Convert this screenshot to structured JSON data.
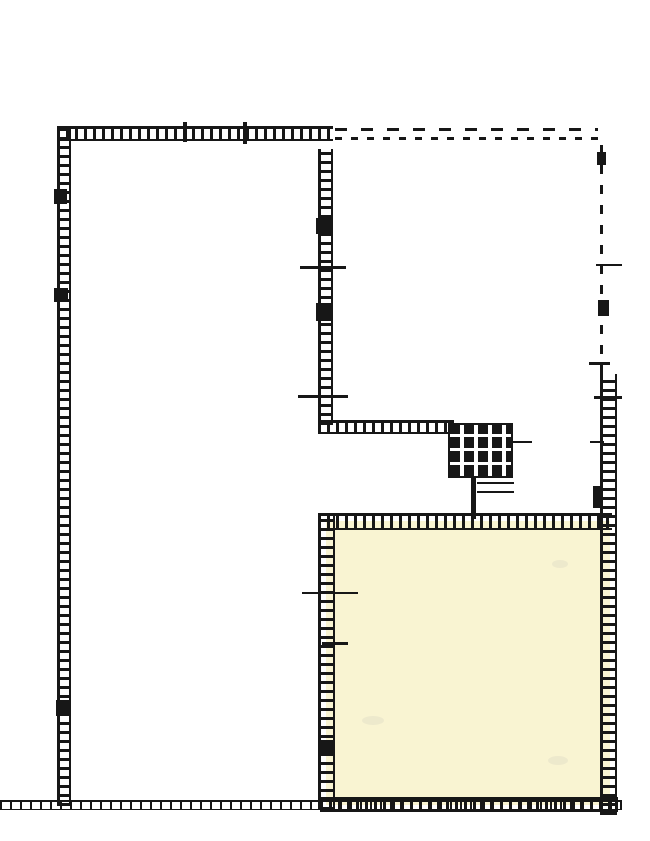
{
  "document": {
    "description": "Scanned monochrome architectural floor plan; cross-hatched walls, dashed upper-right perimeter, central cross-hatched stair block, cream-highlighted room at lower right"
  },
  "plan": {
    "canvas": {
      "width": 650,
      "height": 841,
      "background": "#ffffff"
    },
    "colors": {
      "ink": "#171717",
      "room_fill": "#f9f4d2",
      "smudge": "#ebe6cb"
    },
    "elements": [
      {
        "name": "highlighted-room-fill",
        "type": "room",
        "x": 326,
        "y": 521,
        "w": 284,
        "h": 284
      },
      {
        "name": "room-smudge-1",
        "type": "smudge",
        "x": 552,
        "y": 560,
        "w": 16,
        "h": 8
      },
      {
        "name": "room-smudge-2",
        "type": "smudge",
        "x": 362,
        "y": 716,
        "w": 22,
        "h": 9
      },
      {
        "name": "room-smudge-3",
        "type": "smudge",
        "x": 548,
        "y": 756,
        "w": 20,
        "h": 9
      },
      {
        "name": "top-wall",
        "type": "wall-h",
        "x": 57,
        "y": 126,
        "w": 276,
        "h": 15
      },
      {
        "name": "top-wall-dash-upper",
        "type": "dash-h",
        "x": 335,
        "y": 128,
        "w": 263,
        "h": 3
      },
      {
        "name": "top-wall-dash-lower",
        "type": "dash-h2",
        "x": 335,
        "y": 137,
        "w": 263,
        "h": 3
      },
      {
        "name": "left-wall",
        "type": "wall-v",
        "x": 57,
        "y": 126,
        "w": 14,
        "h": 680
      },
      {
        "name": "middle-wall",
        "type": "wall-v",
        "x": 318,
        "y": 149,
        "w": 15,
        "h": 276
      },
      {
        "name": "mid-horizontal-wall",
        "type": "wall-h",
        "x": 318,
        "y": 420,
        "w": 136,
        "h": 14
      },
      {
        "name": "stair-block",
        "type": "stairs",
        "x": 448,
        "y": 423,
        "w": 65,
        "h": 55
      },
      {
        "name": "stair-side-tick",
        "type": "line",
        "x": 512,
        "y": 441,
        "w": 20,
        "h": 2
      },
      {
        "name": "stair-lower-line-1",
        "type": "line",
        "x": 477,
        "y": 482,
        "w": 37,
        "h": 2
      },
      {
        "name": "stair-lower-line-2",
        "type": "line",
        "x": 477,
        "y": 491,
        "w": 37,
        "h": 2
      },
      {
        "name": "stair-connector-wall",
        "type": "line",
        "x": 471,
        "y": 477,
        "w": 5,
        "h": 42
      },
      {
        "name": "room-top-wall",
        "type": "wall-h",
        "x": 318,
        "y": 513,
        "w": 294,
        "h": 17
      },
      {
        "name": "room-left-wall",
        "type": "wall-v",
        "x": 318,
        "y": 513,
        "w": 17,
        "h": 297
      },
      {
        "name": "right-wall-upper-dashed",
        "type": "dash-v",
        "x": 600,
        "y": 136,
        "w": 3,
        "h": 238
      },
      {
        "name": "right-wall",
        "type": "wall-v",
        "x": 600,
        "y": 374,
        "w": 17,
        "h": 441
      },
      {
        "name": "bottom-wall",
        "type": "wall-h-thin",
        "x": 0,
        "y": 800,
        "w": 622,
        "h": 10
      },
      {
        "name": "room-bottom-wall",
        "type": "wall-h",
        "x": 320,
        "y": 797,
        "w": 298,
        "h": 15
      },
      {
        "name": "top-wall-tick-1",
        "type": "blob",
        "x": 183,
        "y": 122,
        "w": 4,
        "h": 20
      },
      {
        "name": "top-wall-tick-2",
        "type": "blob",
        "x": 243,
        "y": 122,
        "w": 4,
        "h": 22
      },
      {
        "name": "right-wall-tick-upper",
        "type": "line",
        "x": 596,
        "y": 264,
        "w": 26,
        "h": 2
      },
      {
        "name": "right-wall-tick-mid",
        "type": "line",
        "x": 589,
        "y": 362,
        "w": 21,
        "h": 3
      },
      {
        "name": "right-wall-tick-lower",
        "type": "line",
        "x": 594,
        "y": 396,
        "w": 28,
        "h": 3
      },
      {
        "name": "right-wall-tick-small",
        "type": "line",
        "x": 590,
        "y": 441,
        "w": 14,
        "h": 2
      },
      {
        "name": "middle-wall-tick-1",
        "type": "line",
        "x": 300,
        "y": 266,
        "w": 46,
        "h": 3
      },
      {
        "name": "middle-wall-tick-2",
        "type": "line",
        "x": 298,
        "y": 395,
        "w": 50,
        "h": 3
      },
      {
        "name": "room-left-wall-tick-1",
        "type": "line",
        "x": 302,
        "y": 592,
        "w": 56,
        "h": 2
      },
      {
        "name": "room-left-wall-tick-2",
        "type": "line",
        "x": 322,
        "y": 642,
        "w": 26,
        "h": 3
      },
      {
        "name": "left-wall-blob-1",
        "type": "blob",
        "x": 54,
        "y": 189,
        "w": 13,
        "h": 15
      },
      {
        "name": "left-wall-blob-2",
        "type": "blob",
        "x": 54,
        "y": 288,
        "w": 14,
        "h": 14
      },
      {
        "name": "left-wall-blob-3",
        "type": "blob",
        "x": 56,
        "y": 700,
        "w": 13,
        "h": 16
      },
      {
        "name": "middle-wall-blob-1",
        "type": "blob",
        "x": 316,
        "y": 218,
        "w": 15,
        "h": 16
      },
      {
        "name": "middle-wall-blob-2",
        "type": "blob",
        "x": 316,
        "y": 303,
        "w": 15,
        "h": 18
      },
      {
        "name": "right-wall-blob-upper",
        "type": "blob",
        "x": 597,
        "y": 152,
        "w": 9,
        "h": 13
      },
      {
        "name": "right-wall-blob-mid",
        "type": "blob",
        "x": 598,
        "y": 300,
        "w": 11,
        "h": 16
      },
      {
        "name": "right-wall-blob-lower",
        "type": "blob",
        "x": 593,
        "y": 486,
        "w": 8,
        "h": 22
      },
      {
        "name": "room-left-wall-blob",
        "type": "blob",
        "x": 318,
        "y": 740,
        "w": 16,
        "h": 16
      }
    ]
  }
}
